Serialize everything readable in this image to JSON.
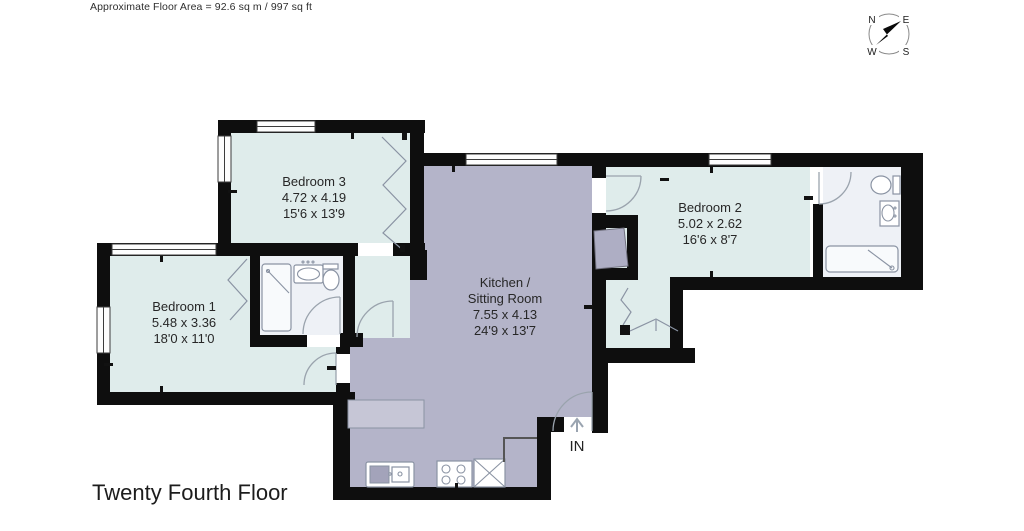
{
  "header": {
    "floor_area": "Approximate Floor Area = 92.6 sq m / 997 sq ft"
  },
  "compass": {
    "north": "N",
    "east": "E",
    "south": "S",
    "west": "W"
  },
  "rooms": {
    "bedroom1": {
      "name": "Bedroom 1",
      "metric": "5.48 x 3.36",
      "imperial": "18'0 x 11'0"
    },
    "bedroom2": {
      "name": "Bedroom 2",
      "metric": "5.02 x 2.62",
      "imperial": "16'6 x 8'7"
    },
    "bedroom3": {
      "name": "Bedroom 3",
      "metric": "4.72 x 4.19",
      "imperial": "15'6 x 13'9"
    },
    "kitchen_sitting": {
      "name_line1": "Kitchen /",
      "name_line2": "Sitting Room",
      "metric": "7.55 x 4.13",
      "imperial": "24'9 x 13'7"
    }
  },
  "entrance": {
    "label": "IN"
  },
  "footer": {
    "title": "Twenty Fourth Floor"
  },
  "colors": {
    "wall": "#0e0e0e",
    "room_fill": "#dfeceb",
    "kitchen_fill": "#b4b4c9",
    "bathroom_fill": "#eef1f6",
    "closet_fill": "#aeaec4",
    "counter_fill": "#c6c6d6"
  }
}
